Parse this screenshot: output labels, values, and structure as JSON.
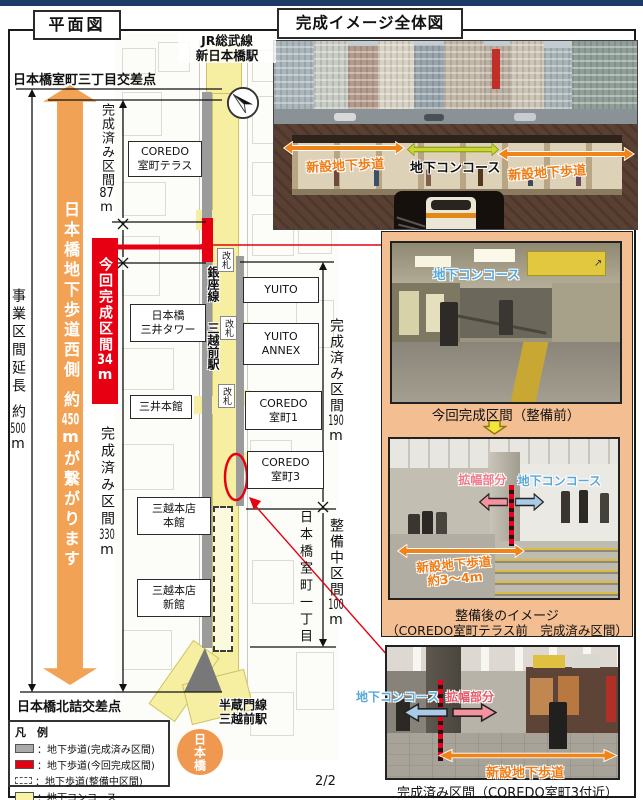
{
  "colors": {
    "navy_bar": "#1E3A66",
    "accent_orange": "#F2A254",
    "highlight_red": "#E60012",
    "concourse_yellow": "#F6EFA1",
    "walkway_gray": "#9B9B9B",
    "panel_peach": "#F3BE92",
    "label_blue": "#55A8DC",
    "label_pink": "#F2788A"
  },
  "page": {
    "number": "2/2"
  },
  "plan": {
    "title": "平面図",
    "top_intersection": "日本橋室町三丁目交差点",
    "bottom_intersection": "日本橋北詰交差点",
    "biz_label": "事業区間延長",
    "biz_approx": "約",
    "biz_num": "500",
    "biz_unit": "m",
    "arrow_line1": "日本橋地下歩道西側",
    "arrow_approx": "約",
    "arrow_num": "450",
    "arrow_unit": "m",
    "arrow_line2": "が繋がります",
    "m87_label": "完成済み区間",
    "m87_num": "87",
    "m87_unit": "m",
    "m34_label": "今回完成区間",
    "m34_num": "34",
    "m34_unit": "m",
    "m330_label": "完成済み区間",
    "m330_num": "330",
    "m330_unit": "m",
    "m190_label": "完成済み区間",
    "m190_num": "190",
    "m190_unit": "m",
    "m100_label": "整備中区間",
    "m100_num": "100",
    "m100_unit": "m",
    "jr_line1": "JR総武線",
    "jr_line2": "新日本橋駅",
    "ginza_line": "銀座線",
    "mitsukoshimae": "三越前駅",
    "kaisatsu": "改札",
    "hanzomon_line1": "半蔵門線",
    "hanzomon_line2": "三越前駅",
    "muromachi_1chome": "日本橋室町一丁目",
    "nihonbashi": "日本橋",
    "buildings": {
      "coredo_terrace_1": "COREDO",
      "coredo_terrace_2": "室町テラス",
      "mitsui_tower_1": "日本橋",
      "mitsui_tower_2": "三井タワー",
      "mitsui_honkan": "三井本館",
      "mitsukoshi_honkan_1": "三越本店",
      "mitsukoshi_honkan_2": "本館",
      "mitsukoshi_shinkan_1": "三越本店",
      "mitsukoshi_shinkan_2": "新館",
      "yuito": "YUITO",
      "yuito_annex_1": "YUITO",
      "yuito_annex_2": "ANNEX",
      "coredo1_1": "COREDO",
      "coredo1_2": "室町1",
      "coredo3_1": "COREDO",
      "coredo3_2": "室町3"
    },
    "legend": {
      "title": "凡　例",
      "row1": "：地下歩道(完成済み区間)",
      "row2": "：地下歩道(今回完成区間)",
      "row3": "：地下歩道(整備中区間)",
      "row4": "：地下コンコース"
    }
  },
  "overview": {
    "title": "完成イメージ全体図",
    "left_walkway_label": "新設地下歩道",
    "concourse_label": "地下コンコース",
    "right_walkway_label": "新設地下歩道"
  },
  "panel": {
    "photo1_concourse_label": "地下コンコース",
    "caption1": "今回完成区間（整備前）",
    "photo2_widen_label": "拡幅部分",
    "photo2_concourse_label": "地下コンコース",
    "photo2_walkway_label_1": "新設地下歩道",
    "photo2_walkway_label_2": "約3～4m",
    "caption2_line1": "整備後のイメージ",
    "caption2_line2": "（COREDO室町テラス前　完成済み区間）"
  },
  "bottom_photo": {
    "concourse_label": "地下コンコース",
    "widen_label": "拡幅部分",
    "walkway_label": "新設地下歩道",
    "caption": "完成済み区間（COREDO室町3付近）"
  }
}
